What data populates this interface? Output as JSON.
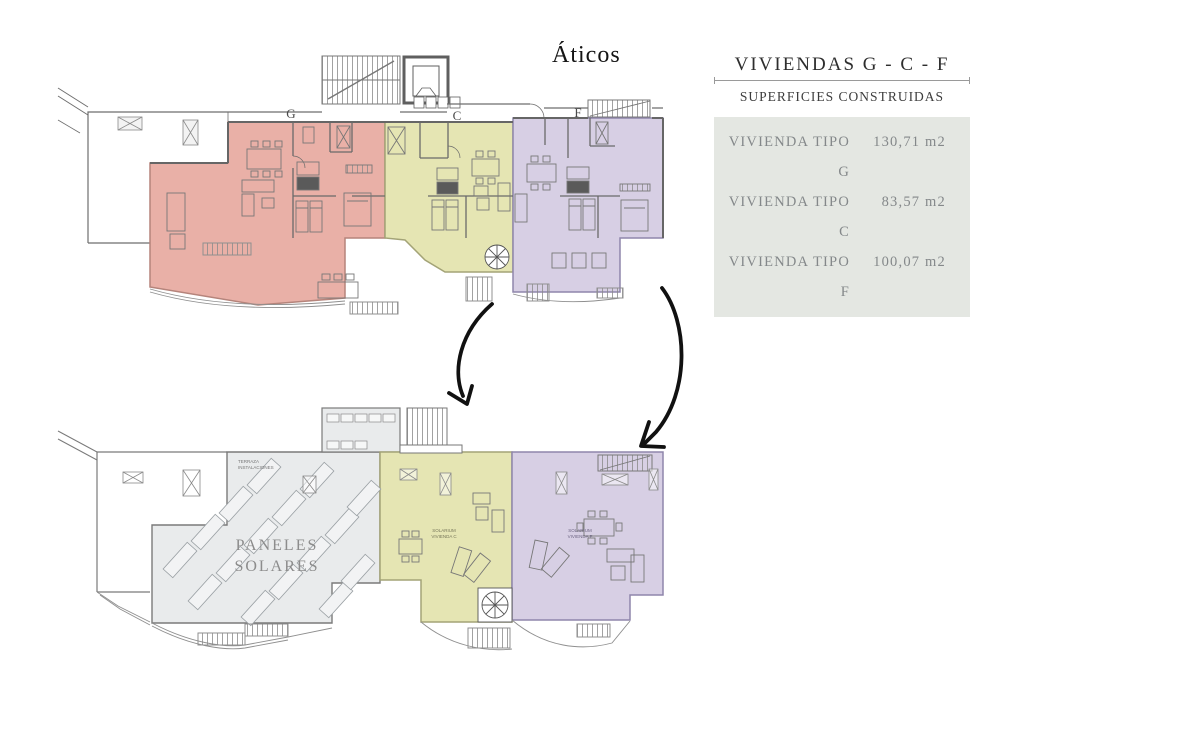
{
  "title": "Áticos",
  "legend": {
    "title": "VIVIENDAS  G - C - F",
    "subtitle": "SUPERFICIES CONSTRUIDAS",
    "rows": [
      {
        "label": "VIVIENDA TIPO G",
        "value": "130,71 m2"
      },
      {
        "label": "VIVIENDA TIPO C",
        "value": "83,57 m2"
      },
      {
        "label": "VIVIENDA TIPO F",
        "value": "100,07 m2"
      }
    ]
  },
  "upper": {
    "label_g": "G",
    "label_c": "C",
    "label_f": "F"
  },
  "lower": {
    "terraza_line1": "TERRAZA",
    "terraza_line2": "INSTALACIONES",
    "paneles_line1": "PANELES",
    "paneles_line2": "SOLARES",
    "solarium_c_line1": "SOLARIUM",
    "solarium_c_line2": "VIVIENDA C",
    "solarium_f_line1": "SOLARIUM",
    "solarium_f_line2": "VIVIENDA F"
  },
  "colors": {
    "unit_g": "#e9b0a7",
    "unit_c": "#e5e5b3",
    "unit_f": "#d7cfe4",
    "roof_gray": "#e9ebec",
    "legend_bg": "#e4e7e2",
    "plan_line": "#6b6b6b",
    "arrow": "#111111"
  }
}
